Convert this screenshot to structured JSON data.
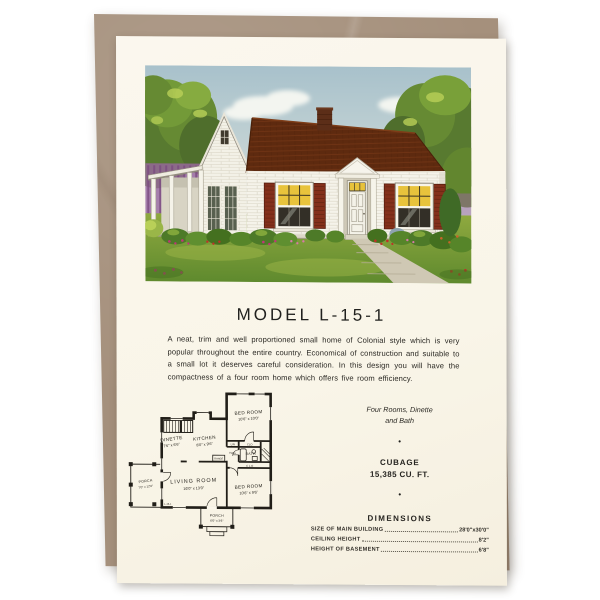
{
  "page": {
    "background": "#ffffff"
  },
  "envelope": {
    "color": "#a5907c"
  },
  "card": {
    "background": "#faf6ea",
    "title": "MODEL L-15-1",
    "description": "A neat, trim and well proportioned small home of Colonial style which is very popular throughout the entire country.  Economical of construction and suitable to a small lot it deserves careful consideration.  In this design you will have the compactness of a four room home which offers five room efficiency.",
    "summary_line1": "Four Rooms, Dinette",
    "summary_line2": "and Bath",
    "bullet": "•",
    "cubage_heading": "CUBAGE",
    "cubage_value": "15,385 CU. FT.",
    "dimensions": {
      "heading": "DIMENSIONS",
      "rows": [
        {
          "label": "SIZE OF MAIN BUILDING",
          "value": "28'0\"x30'0\""
        },
        {
          "label": "CEILING HEIGHT",
          "value": "8'2\""
        },
        {
          "label": "HEIGHT OF BASEMENT",
          "value": "6'8\""
        }
      ]
    }
  },
  "floor_plan": {
    "model_label": "L-15-1",
    "rooms": {
      "bedroom1": {
        "name": "BED ROOM",
        "dims": "10'6\" x 10'0\""
      },
      "kitchen": {
        "name": "KITCHEN",
        "dims": "8'0\" x 9'6\""
      },
      "dinette": {
        "name": "DINETTE",
        "dims": "7'6\" x 6'6\""
      },
      "bath": {
        "name": "BATH"
      },
      "hall": {
        "name": "HALL"
      },
      "living": {
        "name": "LIVING ROOM",
        "dims": "16'0\" x 13'0\""
      },
      "bedroom2": {
        "name": "BED ROOM",
        "dims": "10'6\" x 9'6\""
      },
      "porch_side": {
        "name": "PORCH",
        "dims": "7'0\" x 12'0\""
      },
      "porch_rear": {
        "name": "PORCH",
        "dims": "6'0\" x 3'6\""
      }
    },
    "fixtures": {
      "range": "RANGE",
      "lin": "LIN",
      "clo": "CLO",
      "clo_spaced": "C L O"
    }
  },
  "colors": {
    "roof": "#5e2a0f",
    "shutters": "#84301b",
    "window_glow": "#e8c33c",
    "lawn": "#6f9635",
    "sky": "#b3c9d0",
    "envelope": "#a5907c",
    "card": "#faf6ea"
  }
}
